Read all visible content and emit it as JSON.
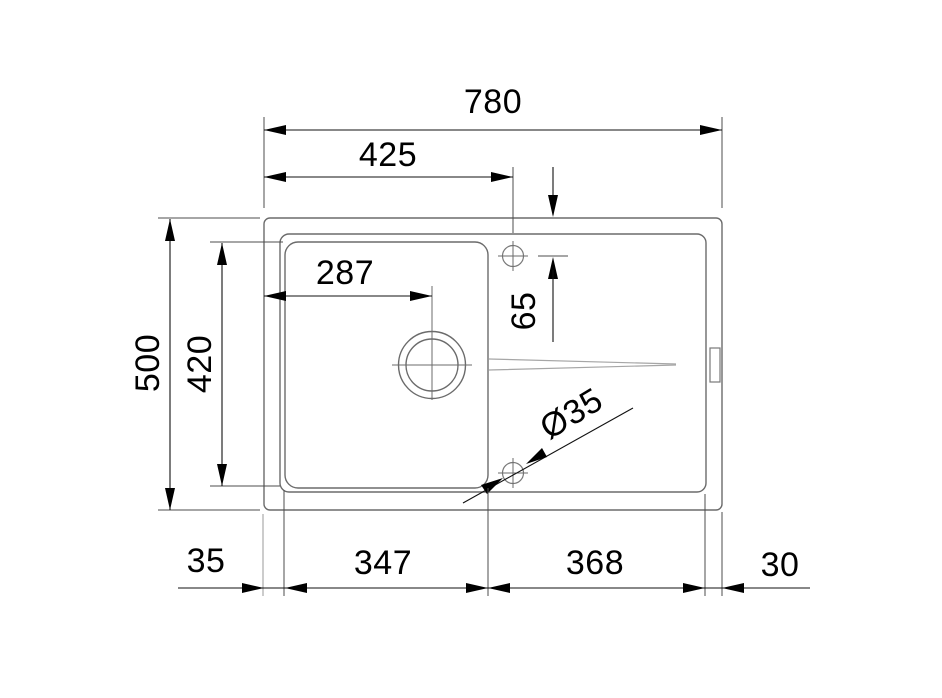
{
  "drawing": {
    "description": "Technical top-view installation drawing of a kitchen sink with single bowl, drain hole, faucet holes and drainboard",
    "background": "#ffffff",
    "line_color": "#111111",
    "outline_color": "#6b6b6b"
  },
  "dims_top": {
    "overall_width": "780",
    "left_edge_to_faucet_hole": "425"
  },
  "dims_left": {
    "overall_depth": "500",
    "bowl_inner_depth": "420"
  },
  "dims_inner": {
    "left_edge_to_drain_center": "287",
    "top_edge_to_faucet_hole": "65",
    "accessory_hole_diameter": "Ø35"
  },
  "dims_bottom": {
    "left_rim": "35",
    "bowl_width": "347",
    "drainboard_width": "368",
    "right_rim": "30"
  }
}
